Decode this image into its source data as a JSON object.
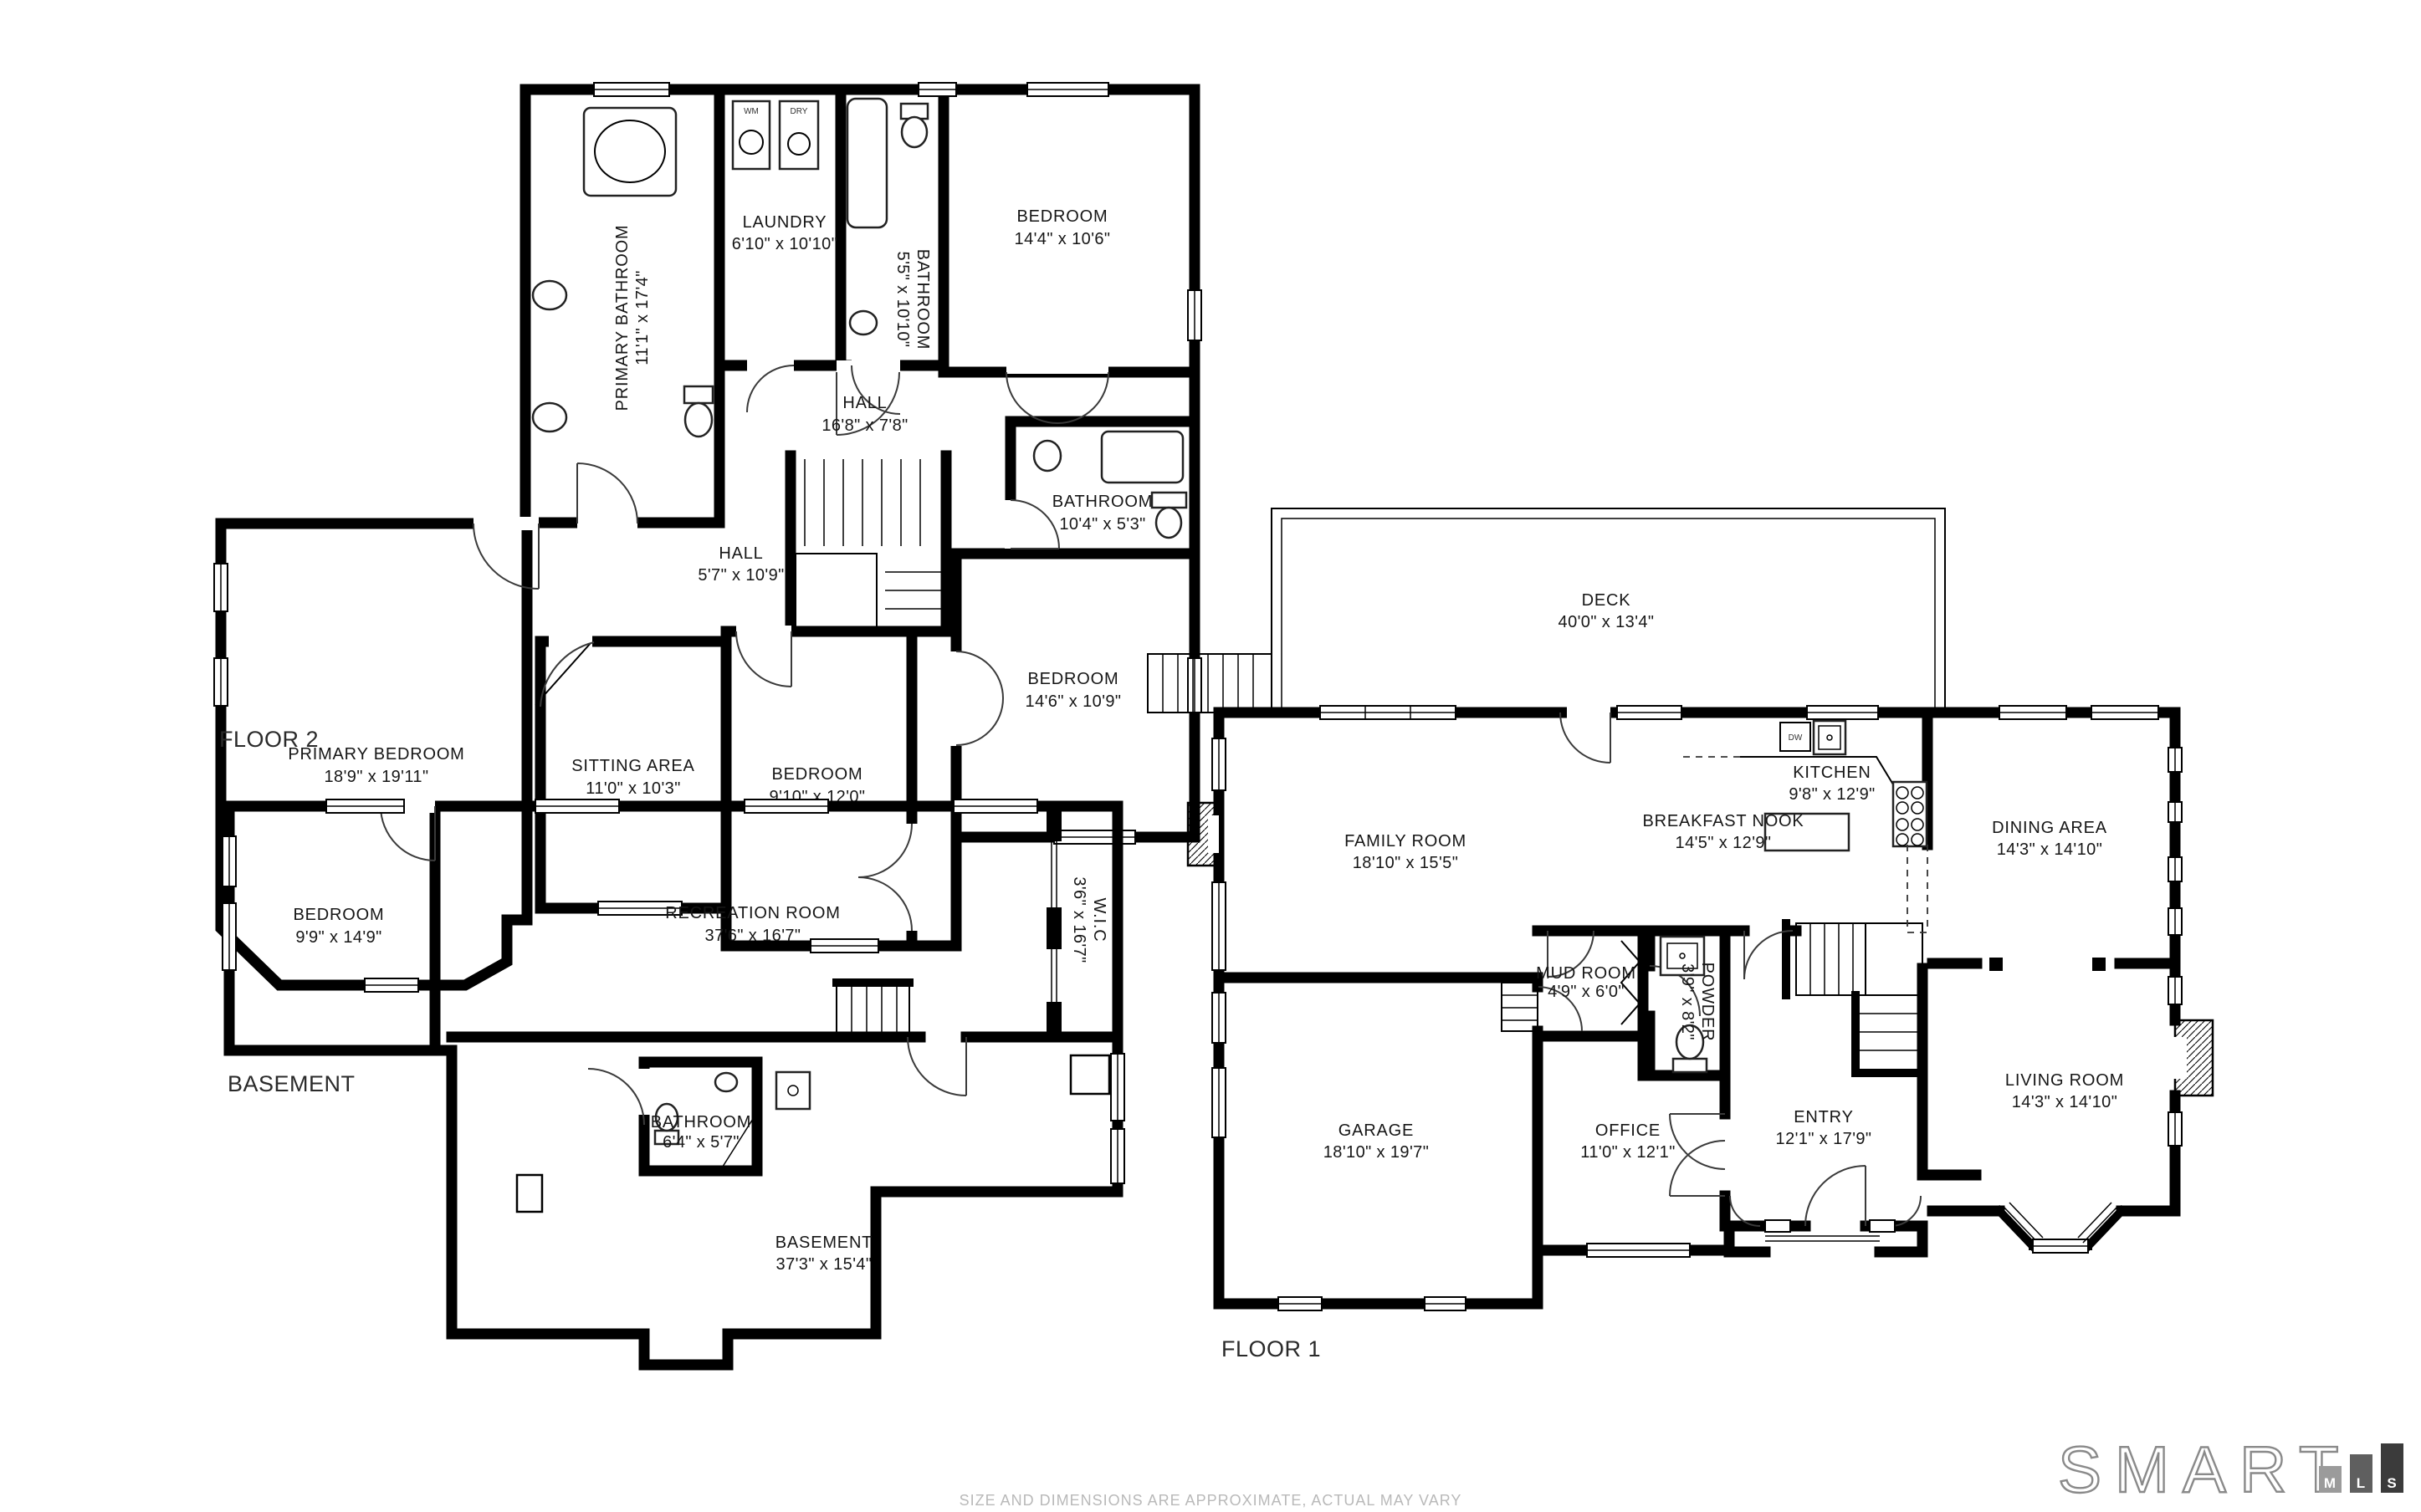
{
  "page": {
    "background": "#ffffff",
    "disclaimer": "SIZE AND DIMENSIONS ARE APPROXIMATE, ACTUAL MAY VARY"
  },
  "logo": {
    "word": "SMART",
    "bars": [
      {
        "letter": "M",
        "color": "#9b9b9b"
      },
      {
        "letter": "L",
        "color": "#5f5f5f"
      },
      {
        "letter": "S",
        "color": "#3b3b3b"
      }
    ]
  },
  "fixture_labels": {
    "washer": "WM",
    "dryer": "DRY",
    "dishwasher": "DW"
  },
  "floors": [
    {
      "label": "FLOOR 2",
      "rooms": [
        {
          "name": "PRIMARY BATHROOM",
          "dims": "11'1\" x 17'4\"",
          "orientation": "vertical"
        },
        {
          "name": "LAUNDRY",
          "dims": "6'10\" x 10'10\""
        },
        {
          "name": "BATHROOM",
          "dims": "5'5\" x 10'10\"",
          "orientation": "vertical"
        },
        {
          "name": "BEDROOM",
          "dims": "14'4\" x 10'6\""
        },
        {
          "name": "HALL",
          "dims": "16'8\" x 7'8\""
        },
        {
          "name": "BATHROOM",
          "dims": "10'4\" x 5'3\""
        },
        {
          "name": "HALL",
          "dims": "5'7\" x 10'9\""
        },
        {
          "name": "PRIMARY BEDROOM",
          "dims": "18'9\" x 19'11\""
        },
        {
          "name": "SITTING AREA",
          "dims": "11'0\" x 10'3\""
        },
        {
          "name": "BEDROOM",
          "dims": "9'10\" x 12'0\""
        },
        {
          "name": "BEDROOM",
          "dims": "14'6\" x 10'9\""
        }
      ]
    },
    {
      "label": "BASEMENT",
      "rooms": [
        {
          "name": "BEDROOM",
          "dims": "9'9\" x 14'9\""
        },
        {
          "name": "RECREATION ROOM",
          "dims": "37'6\" x 16'7\""
        },
        {
          "name": "W.I.C",
          "dims": "3'6\" x 16'7\"",
          "orientation": "vertical"
        },
        {
          "name": "BATHROOM",
          "dims": "6'4\" x 5'7\""
        },
        {
          "name": "BASEMENT",
          "dims": "37'3\" x 15'4\""
        }
      ]
    },
    {
      "label": "FLOOR 1",
      "rooms": [
        {
          "name": "DECK",
          "dims": "40'0\" x 13'4\""
        },
        {
          "name": "FAMILY ROOM",
          "dims": "18'10\" x 15'5\""
        },
        {
          "name": "BREAKFAST NOOK",
          "dims": "14'5\" x 12'9\""
        },
        {
          "name": "KITCHEN",
          "dims": "9'8\" x 12'9\""
        },
        {
          "name": "DINING AREA",
          "dims": "14'3\" x 14'10\""
        },
        {
          "name": "MUD ROOM",
          "dims": "4'9\" x 6'0\""
        },
        {
          "name": "POWDER",
          "dims": "3'9\" x 8'2\"",
          "orientation": "vertical"
        },
        {
          "name": "GARAGE",
          "dims": "18'10\" x 19'7\""
        },
        {
          "name": "OFFICE",
          "dims": "11'0\" x 12'1\""
        },
        {
          "name": "ENTRY",
          "dims": "12'1\" x 17'9\""
        },
        {
          "name": "LIVING ROOM",
          "dims": "14'3\" x 14'10\""
        }
      ]
    }
  ]
}
